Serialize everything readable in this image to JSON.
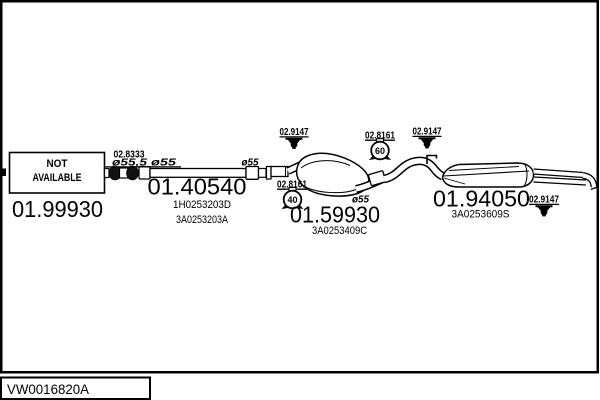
{
  "footer": {
    "drawing_code": "VW0016820A"
  },
  "colors": {
    "ink": "#000000",
    "paper": "#ffffff"
  },
  "diagram": {
    "front_section": {
      "part_number": "01.99930",
      "availability": {
        "line1": "NOT",
        "line2": "AVAILABLE"
      }
    },
    "front_joint": {
      "part_number": "02.8333",
      "dia_large": "ø55,5",
      "dia_small": "ø55"
    },
    "middle_pipe": {
      "part_number": "01.40540",
      "oem_code_1": "1H0253203D",
      "oem_code_2": "3A0253203A",
      "dia_end": "ø55"
    },
    "center_muffler": {
      "part_number": "01.59930",
      "oem_code_1": "3A0253409C",
      "dia_out": "ø55",
      "clamp_top": {
        "part_number": "02.9147"
      },
      "hanger": {
        "part_number": "02.8161",
        "size": "40"
      }
    },
    "rear_muffler": {
      "part_number": "01.94050",
      "oem_code_1": "3A0253609S",
      "hanger": {
        "part_number": "02.8161",
        "size": "60"
      },
      "clamp_inlet": {
        "part_number": "02.9147"
      },
      "clamp_tail": {
        "part_number": "02.9147"
      }
    }
  }
}
